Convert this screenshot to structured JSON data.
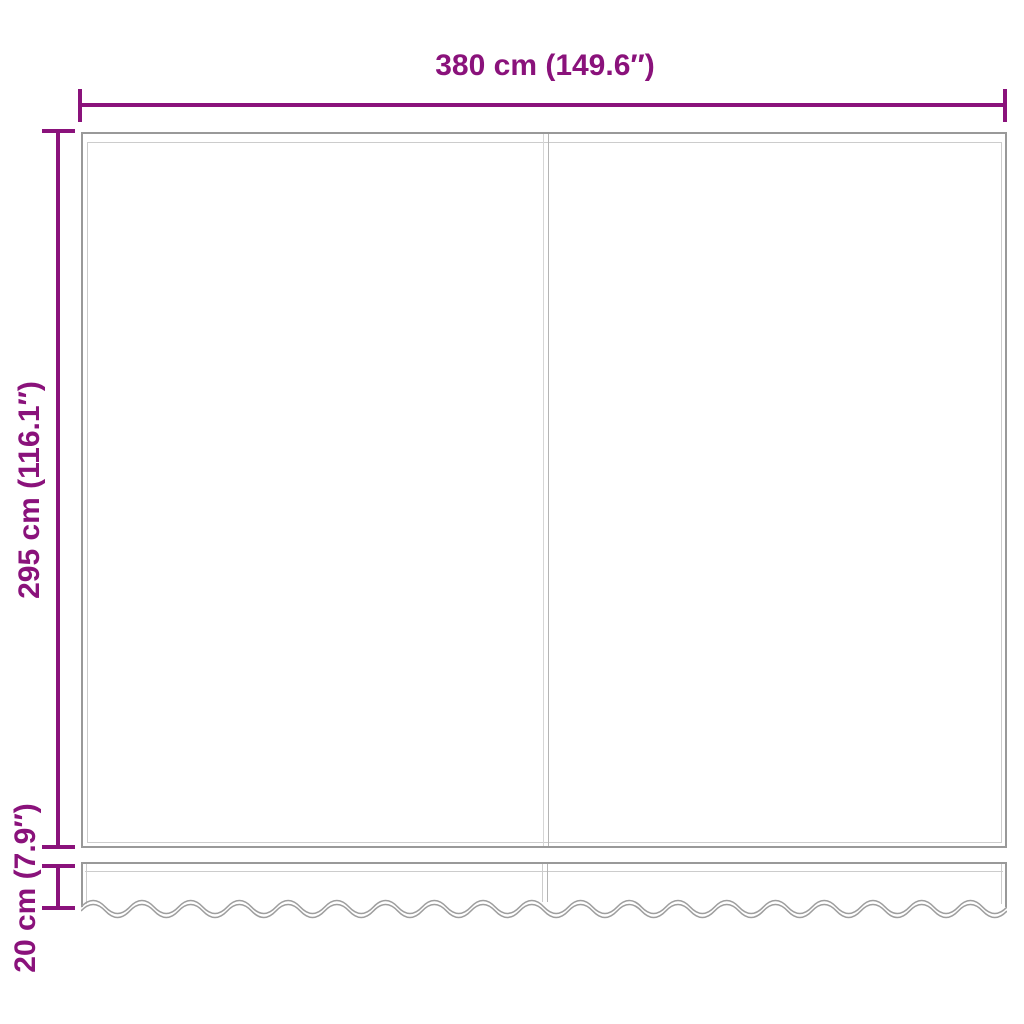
{
  "diagram": {
    "labels": {
      "width": "380 cm (149.6″)",
      "height": "295 cm (116.1″)",
      "valance_height": "20 cm (7.9″)"
    },
    "colors": {
      "dimension": "#8a127b",
      "outline": "#999999",
      "hem_line": "#cccccc",
      "seam_line": "#b5b5b5",
      "wave_line": "#9e9e9e",
      "background": "#ffffff"
    }
  }
}
